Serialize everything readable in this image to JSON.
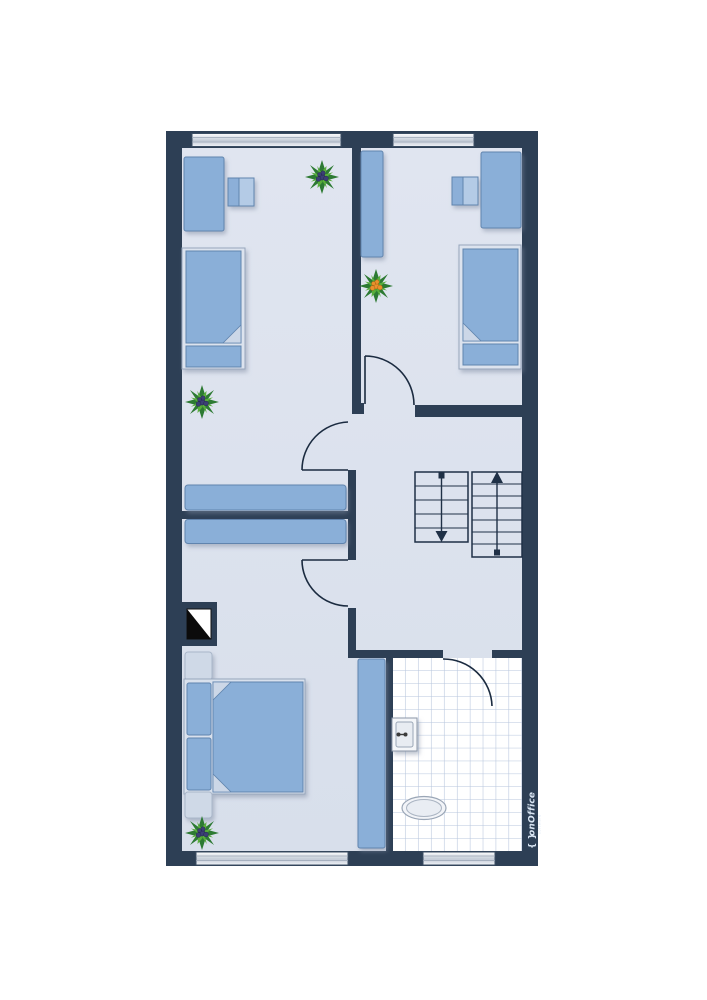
{
  "branding": {
    "logo_braces": "{ }",
    "logo_text": "onOffice",
    "logo_subtext": "software"
  },
  "palette": {
    "wall": "#2d3f55",
    "floor": "#dce2ed",
    "furniture_blue": "#8aafd8",
    "furniture_blue_border": "#6084ae",
    "furniture_light": "#cfd9e7",
    "tile_line": "#b7c6dd",
    "door_line": "#1b2b40",
    "stair_line": "#1f3046",
    "plant_green_dark": "#2d7a33",
    "plant_green_light": "#58ae3a",
    "berry_blue": "#3b3f75",
    "berry_orange": "#e8912d"
  },
  "floorplan": {
    "type": "upper-floor residential plan",
    "rooms": [
      {
        "name": "bedroom-top-left",
        "furniture": [
          "desk",
          "desk-chair",
          "single-bed",
          "sideboard",
          "plant",
          "plant"
        ],
        "windows": 1,
        "doors": 1
      },
      {
        "name": "bedroom-top-right",
        "furniture": [
          "wardrobe",
          "desk",
          "desk-chair",
          "single-bed",
          "plant"
        ],
        "windows": 1,
        "doors": 1
      },
      {
        "name": "hallway",
        "features": [
          "staircase-flight-down",
          "staircase-flight-up"
        ]
      },
      {
        "name": "bedroom-bottom-left",
        "furniture": [
          "double-bed",
          "nightstand",
          "nightstand",
          "sideboard",
          "wardrobe",
          "chimney-shaft",
          "plant"
        ],
        "windows": 1,
        "doors": 1
      },
      {
        "name": "bathroom",
        "furniture": [
          "sink",
          "toilet"
        ],
        "floor": "tiled",
        "windows": 1,
        "doors": 1
      }
    ],
    "stairs": {
      "flights": 2,
      "left_flight_direction": "down",
      "right_flight_direction": "up"
    },
    "window_count": 4,
    "door_count": 4
  }
}
